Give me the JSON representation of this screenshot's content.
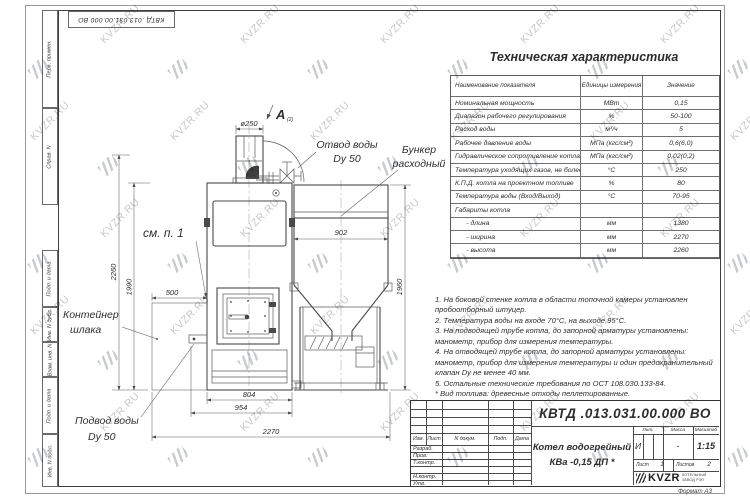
{
  "watermark": {
    "text": "KVZR.RU"
  },
  "frame": {
    "stamp_vertical_top": "КВТД .013.031.00.000 ВО",
    "left_fields_top": [
      "Перв. примен.",
      "Справ. N"
    ],
    "left_fields_bottom": [
      "Подп. и дата",
      "Инв. N дубл.",
      "Взам. инв. N",
      "Подп. и дата",
      "Инв. N подл."
    ],
    "format_label": "Формат А3"
  },
  "spec_table": {
    "title": "Техническая характеристика",
    "headers": [
      "Наименование показателя",
      "Единицы измерения",
      "Значение"
    ],
    "rows": [
      [
        "Номинальная мощность",
        "МВт",
        "0,15"
      ],
      [
        "Диапазон рабочего регулирования",
        "%",
        "50-100"
      ],
      [
        "Расход воды",
        "м³/ч",
        "5"
      ],
      [
        "Рабочее давление воды",
        "МПа (кгс/см²)",
        "0,6(6,0)"
      ],
      [
        "Гидравлическое сопротивление котла",
        "МПа (кгс/см²)",
        "0,02(0,2)"
      ],
      [
        "Температура уходящих газов, не более",
        "°С",
        "250"
      ],
      [
        "К.П.Д. котла на проектном топливе",
        "%",
        "80"
      ],
      [
        "Температура воды (Вход/Выход)",
        "°С",
        "70-95"
      ],
      [
        "Габариты котла",
        "",
        ""
      ],
      [
        "      - длина",
        "мм",
        "1380"
      ],
      [
        "      - ширина",
        "мм",
        "2270"
      ],
      [
        "      - высота",
        "мм",
        "2260"
      ]
    ]
  },
  "notes": {
    "items": [
      "1. На боковой стенке котла в области топочной камеры установлен пробоотборный штуцер.",
      "2. Температура воды на входе 70°С, на выходе 95°С.",
      "3. На подводящей трубе котла, до запорной арматуры установлены: манометр, прибор для измерения температуры.",
      "4. На отводящей трубе котла, до запорной арматуры установлены: манометр, прибор для измерения температуры и один предохранительный клапан Dу не менее 40 мм.",
      "5. Остальные технические требования по ОСТ 108.030.133-84."
    ],
    "fuel_note": "* Вид топлива: древесные отходы пеллетированные."
  },
  "drawing": {
    "labels": {
      "view": "А",
      "view_sub": "(2)",
      "outlet_line1": "Отвод воды",
      "outlet_line2": "Dy 50",
      "bunker_line1": "Бункер",
      "bunker_line2": "расходный",
      "see_note": "см. п. 1",
      "container_line1": "Контейнер",
      "container_line2": "шлака",
      "inlet_line1": "Подвод воды",
      "inlet_line2": "Dy 50"
    },
    "dimensions": {
      "chimney_d": "ø250",
      "bunker_w": "902",
      "h_total": "2260",
      "h_boiler": "1990",
      "h_bunker": "1960",
      "w_container": "500",
      "w_804": "804",
      "w_954": "954",
      "w_total": "2270"
    }
  },
  "title_block": {
    "doc_number": "КВТД .013.031.00.000  ВО",
    "doc_name_line1": "Котел водогрейный",
    "doc_name_line2": "КВа -0,15  ДП *",
    "header_cols": [
      "Изм.",
      "Лист",
      "N докум.",
      "Подп.",
      "Дата"
    ],
    "row_labels": [
      "Разраб.",
      "Пров.",
      "Т.контр.",
      "Н.контр.",
      "Утв."
    ],
    "lit_label": "Лит.",
    "lit_value": "И",
    "mass_label": "Масса",
    "mass_value": "-",
    "scale_label": "Масштаб",
    "scale_value": "1:15",
    "sheet_label": "Лист",
    "sheet_value": "1",
    "sheets_label": "Листов",
    "sheets_value": "2",
    "logo_text": "KVZR",
    "org_line1": "КОТЕЛЬНЫЙ",
    "org_line2": "ЗАВОД РЭП"
  }
}
